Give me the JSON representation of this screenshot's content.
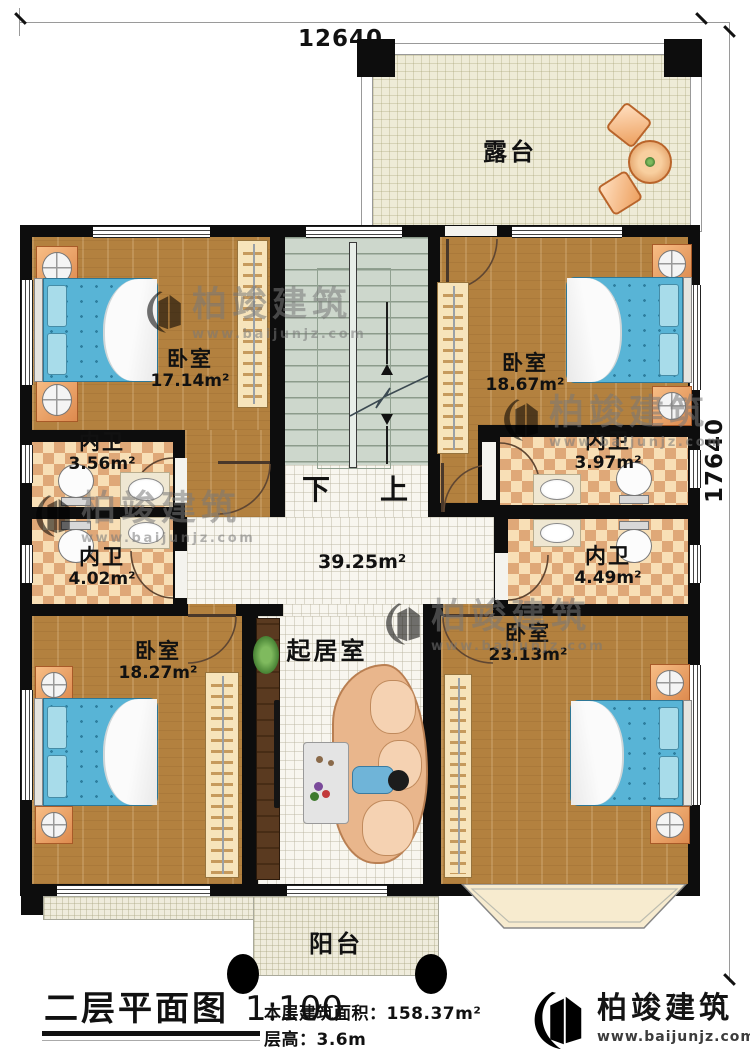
{
  "dimensions": {
    "top": "12640",
    "right": "17640"
  },
  "rooms": {
    "terrace": {
      "name": "露台"
    },
    "bedroom_tl": {
      "name": "卧室",
      "area": "17.14m²"
    },
    "bedroom_tr": {
      "name": "卧室",
      "area": "18.67m²"
    },
    "bath_tl": {
      "name": "内卫",
      "area": "3.56m²"
    },
    "bath_tr": {
      "name": "内卫",
      "area": "3.97m²"
    },
    "bath_ml": {
      "name": "内卫",
      "area": "4.02m²"
    },
    "bath_mr": {
      "name": "内卫",
      "area": "4.49m²"
    },
    "hall": {
      "area": "39.25m²"
    },
    "living": {
      "name": "起居室"
    },
    "bedroom_bl": {
      "name": "卧室",
      "area": "18.27m²"
    },
    "bedroom_br": {
      "name": "卧室",
      "area": "23.13m²"
    },
    "balcony": {
      "name": "阳台"
    }
  },
  "stairs": {
    "down": "下",
    "up": "上"
  },
  "titleblock": {
    "title": "二层平面图",
    "scale": "1:100",
    "area_label": "本层建筑面积：",
    "area_value": "158.37m²",
    "floor_height_label": "层高：",
    "floor_height_value": "3.6m"
  },
  "brand": {
    "name": "柏竣建筑",
    "url": "www.baijunjz.com"
  },
  "watermark": {
    "name": "柏竣建筑",
    "url": "www.baijunjz.com"
  },
  "colors": {
    "wall": "#0d0d0d",
    "wood": "#b3813f",
    "tile": "#f8f6ef",
    "checker_light": "#f8dfb6",
    "checker_dark": "#dfa878",
    "stair": "#cdd7cc",
    "terrace": "#eeebd7",
    "accent_blue": "#1565a8",
    "accent_orange": "#f2960f",
    "bed": "#58b4d6"
  }
}
